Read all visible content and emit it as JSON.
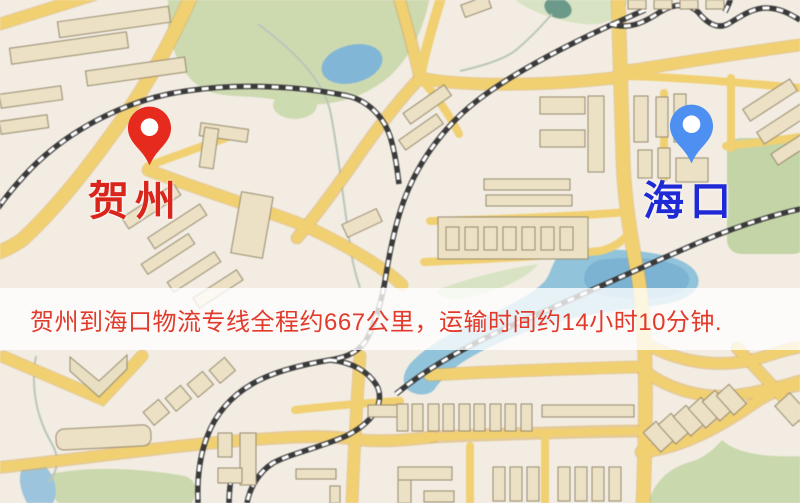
{
  "map": {
    "origin": {
      "name": "贺州",
      "pin": "red-map-pin"
    },
    "destination": {
      "name": "海口",
      "pin": "blue-map-pin"
    }
  },
  "banner": {
    "text": "贺州到海口物流专线全程约667公里，运输时间约14小时10分钟.",
    "distance_km": "667",
    "duration": "14小时10分钟"
  },
  "colors": {
    "map_base": "#f2ece2",
    "road_yellow": "#f2d06e",
    "road_casing": "#d9a850",
    "park_green": "#cdd9ae",
    "water_blue": "#8fc3dc",
    "railway_dark": "#3a3a3a",
    "building_tan": "#ece1c4",
    "origin_red": "#da251c",
    "destination_blue": "#2029d6",
    "origin_pin_red": "#e62b1e",
    "destination_pin_blue": "#4d90f2",
    "banner_bg": "rgba(255,255,255,0.78)",
    "banner_text": "#e23a2b"
  }
}
